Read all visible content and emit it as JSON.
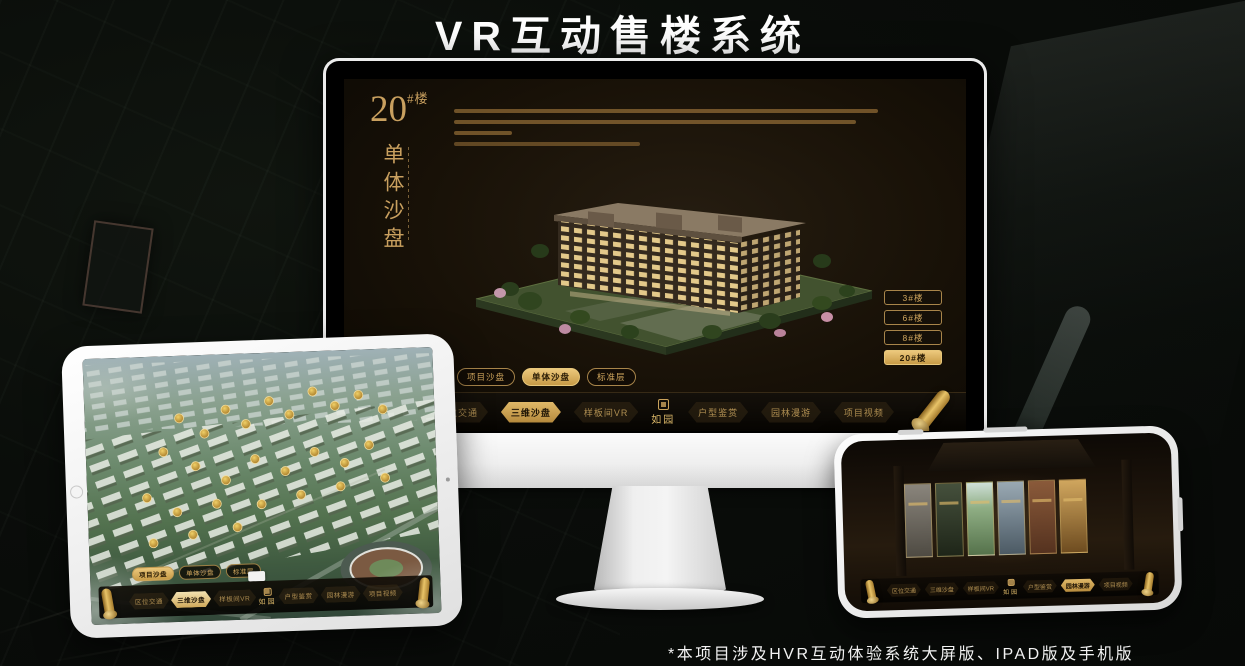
{
  "page": {
    "title": "VR互动售楼系统",
    "footer_note": "*本项目涉及HVR互动体验系统大屏版、IPAD版及手机版"
  },
  "colors": {
    "gold_accent": "#c9a05a",
    "gold_selected": "#dfb868",
    "screen_bg": "#181107"
  },
  "monitor_screen": {
    "building_no": "20",
    "building_no_suffix": "#楼",
    "building_type_vertical": "单体沙盘",
    "floor_buttons": [
      {
        "label": "3#楼",
        "selected": false
      },
      {
        "label": "6#楼",
        "selected": false
      },
      {
        "label": "8#楼",
        "selected": false
      },
      {
        "label": "20#楼",
        "selected": true
      }
    ],
    "view_tabs": [
      {
        "label": "项目沙盘",
        "selected": false
      },
      {
        "label": "单体沙盘",
        "selected": true
      },
      {
        "label": "标准层",
        "selected": false
      }
    ],
    "menu": {
      "logo": "如园",
      "items": [
        {
          "label": "区位交通",
          "selected": false
        },
        {
          "label": "三维沙盘",
          "selected": true
        },
        {
          "label": "样板间VR",
          "selected": false
        },
        {
          "label": "户型鉴赏",
          "selected": false
        },
        {
          "label": "园林漫游",
          "selected": false
        },
        {
          "label": "项目视频",
          "selected": false
        }
      ]
    }
  },
  "ipad_screen": {
    "view_tabs": [
      {
        "label": "项目沙盘",
        "selected": true
      },
      {
        "label": "单体沙盘",
        "selected": false
      },
      {
        "label": "标准层",
        "selected": false
      }
    ],
    "menu": {
      "logo": "如园",
      "items": [
        {
          "label": "区位交通",
          "selected": false
        },
        {
          "label": "三维沙盘",
          "selected": true
        },
        {
          "label": "样板间VR",
          "selected": false
        },
        {
          "label": "户型鉴赏",
          "selected": false
        },
        {
          "label": "园林漫游",
          "selected": false
        },
        {
          "label": "项目视频",
          "selected": false
        }
      ]
    }
  },
  "phone_screen": {
    "menu": {
      "logo": "如园",
      "items": [
        {
          "label": "区位交通",
          "selected": false
        },
        {
          "label": "三维沙盘",
          "selected": false
        },
        {
          "label": "样板间VR",
          "selected": false
        },
        {
          "label": "户型鉴赏",
          "selected": false
        },
        {
          "label": "园林漫游",
          "selected": true
        },
        {
          "label": "项目视频",
          "selected": false
        }
      ]
    }
  }
}
